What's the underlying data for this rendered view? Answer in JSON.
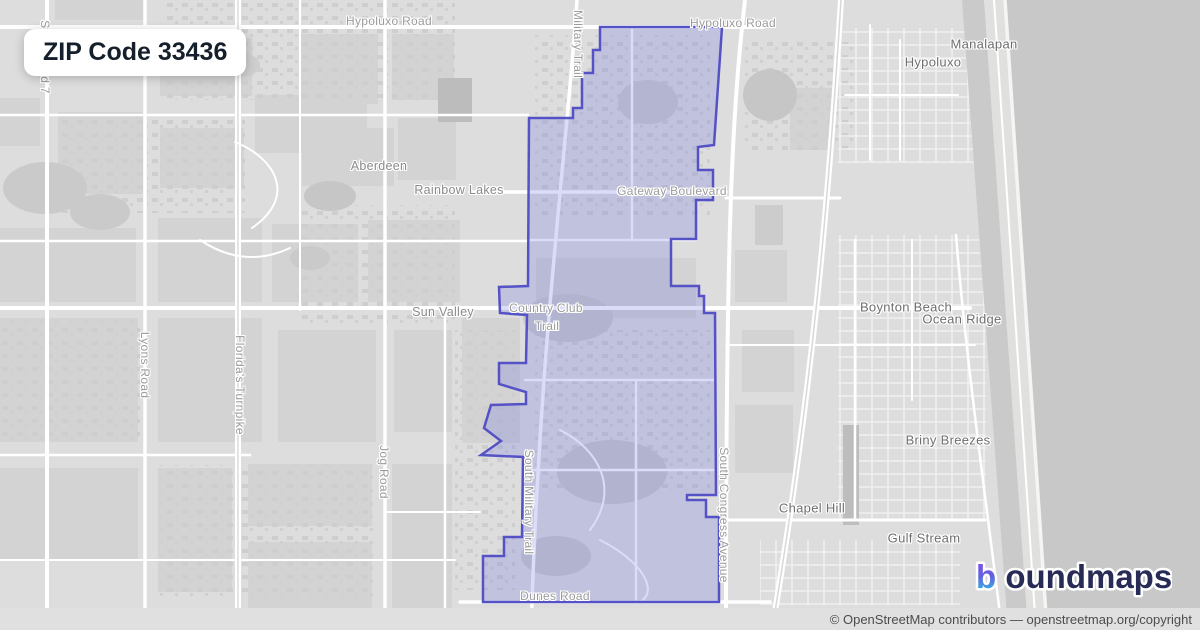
{
  "badge": {
    "label": "ZIP Code 33436"
  },
  "map": {
    "boundary": {
      "name": "ZIP Code 33436 boundary",
      "stroke": "#5552c6",
      "fill": "rgba(112,116,226,0.25)",
      "points": "600,27 722,27 714,145 698,147 698,170 713,170 713,200 696,200 696,239 671,239 671,286 699,286 699,296 704,296 704,313 715,313 716,495 687,495 687,500 706,500 706,517 719,517 719,602 483,602 483,556 504,556 504,537 522,537 523,457 481,455 501,441 484,428 491,405 526,404 526,392 499,384 499,363 526,363 527,315 500,313 499,287 528,286 529,118 573,118 573,108 582,108 582,73 593,73 593,50 600,50"
    },
    "road_labels": [
      {
        "text": "Hypoluxo Road",
        "x": 389,
        "y": 21,
        "rotate": 0
      },
      {
        "text": "Hypoluxo Road",
        "x": 733,
        "y": 23,
        "rotate": 0
      },
      {
        "text": "Military Trail",
        "x": 578,
        "y": 44,
        "rotate": 90
      },
      {
        "text": "Gateway Boulevard",
        "x": 672,
        "y": 191,
        "rotate": 0
      },
      {
        "text": "Country Club",
        "x": 546,
        "y": 308,
        "rotate": 0
      },
      {
        "text": "Trail",
        "x": 547,
        "y": 326,
        "rotate": 0
      },
      {
        "text": "Lyons Road",
        "x": 145,
        "y": 365,
        "rotate": 90
      },
      {
        "text": "Florida's Turnpike",
        "x": 240,
        "y": 385,
        "rotate": 90
      },
      {
        "text": "Jog Road",
        "x": 384,
        "y": 472,
        "rotate": 90
      },
      {
        "text": "South Military Trail",
        "x": 529,
        "y": 502,
        "rotate": 90
      },
      {
        "text": "South Congress Avenue",
        "x": 724,
        "y": 515,
        "rotate": 90
      },
      {
        "text": "Dunes Road",
        "x": 555,
        "y": 596,
        "rotate": 0
      },
      {
        "text": "State Road 7",
        "x": 45,
        "y": 57,
        "rotate": 90
      }
    ],
    "area_labels": [
      {
        "text": "Aberdeen",
        "x": 379,
        "y": 166
      },
      {
        "text": "Rainbow Lakes",
        "x": 459,
        "y": 190
      },
      {
        "text": "Sun Valley",
        "x": 443,
        "y": 312
      }
    ],
    "city_labels": [
      {
        "text": "Manalapan",
        "x": 984,
        "y": 44
      },
      {
        "text": "Hypoluxo",
        "x": 933,
        "y": 62
      },
      {
        "text": "Boynton Beach",
        "x": 906,
        "y": 307
      },
      {
        "text": "Ocean Ridge",
        "x": 962,
        "y": 319
      },
      {
        "text": "Briny Breezes",
        "x": 948,
        "y": 440
      },
      {
        "text": "Chapel Hill",
        "x": 812,
        "y": 508
      },
      {
        "text": "Gulf Stream",
        "x": 924,
        "y": 538
      }
    ]
  },
  "attribution": {
    "text": "© OpenStreetMap contributors — openstreetmap.org/copyright"
  },
  "logo": {
    "b": "b",
    "rest": "oundmaps",
    "gradient": [
      "#8b47ee",
      "#5f63dd",
      "#2cc7e9"
    ],
    "text_color": "#272b56"
  }
}
